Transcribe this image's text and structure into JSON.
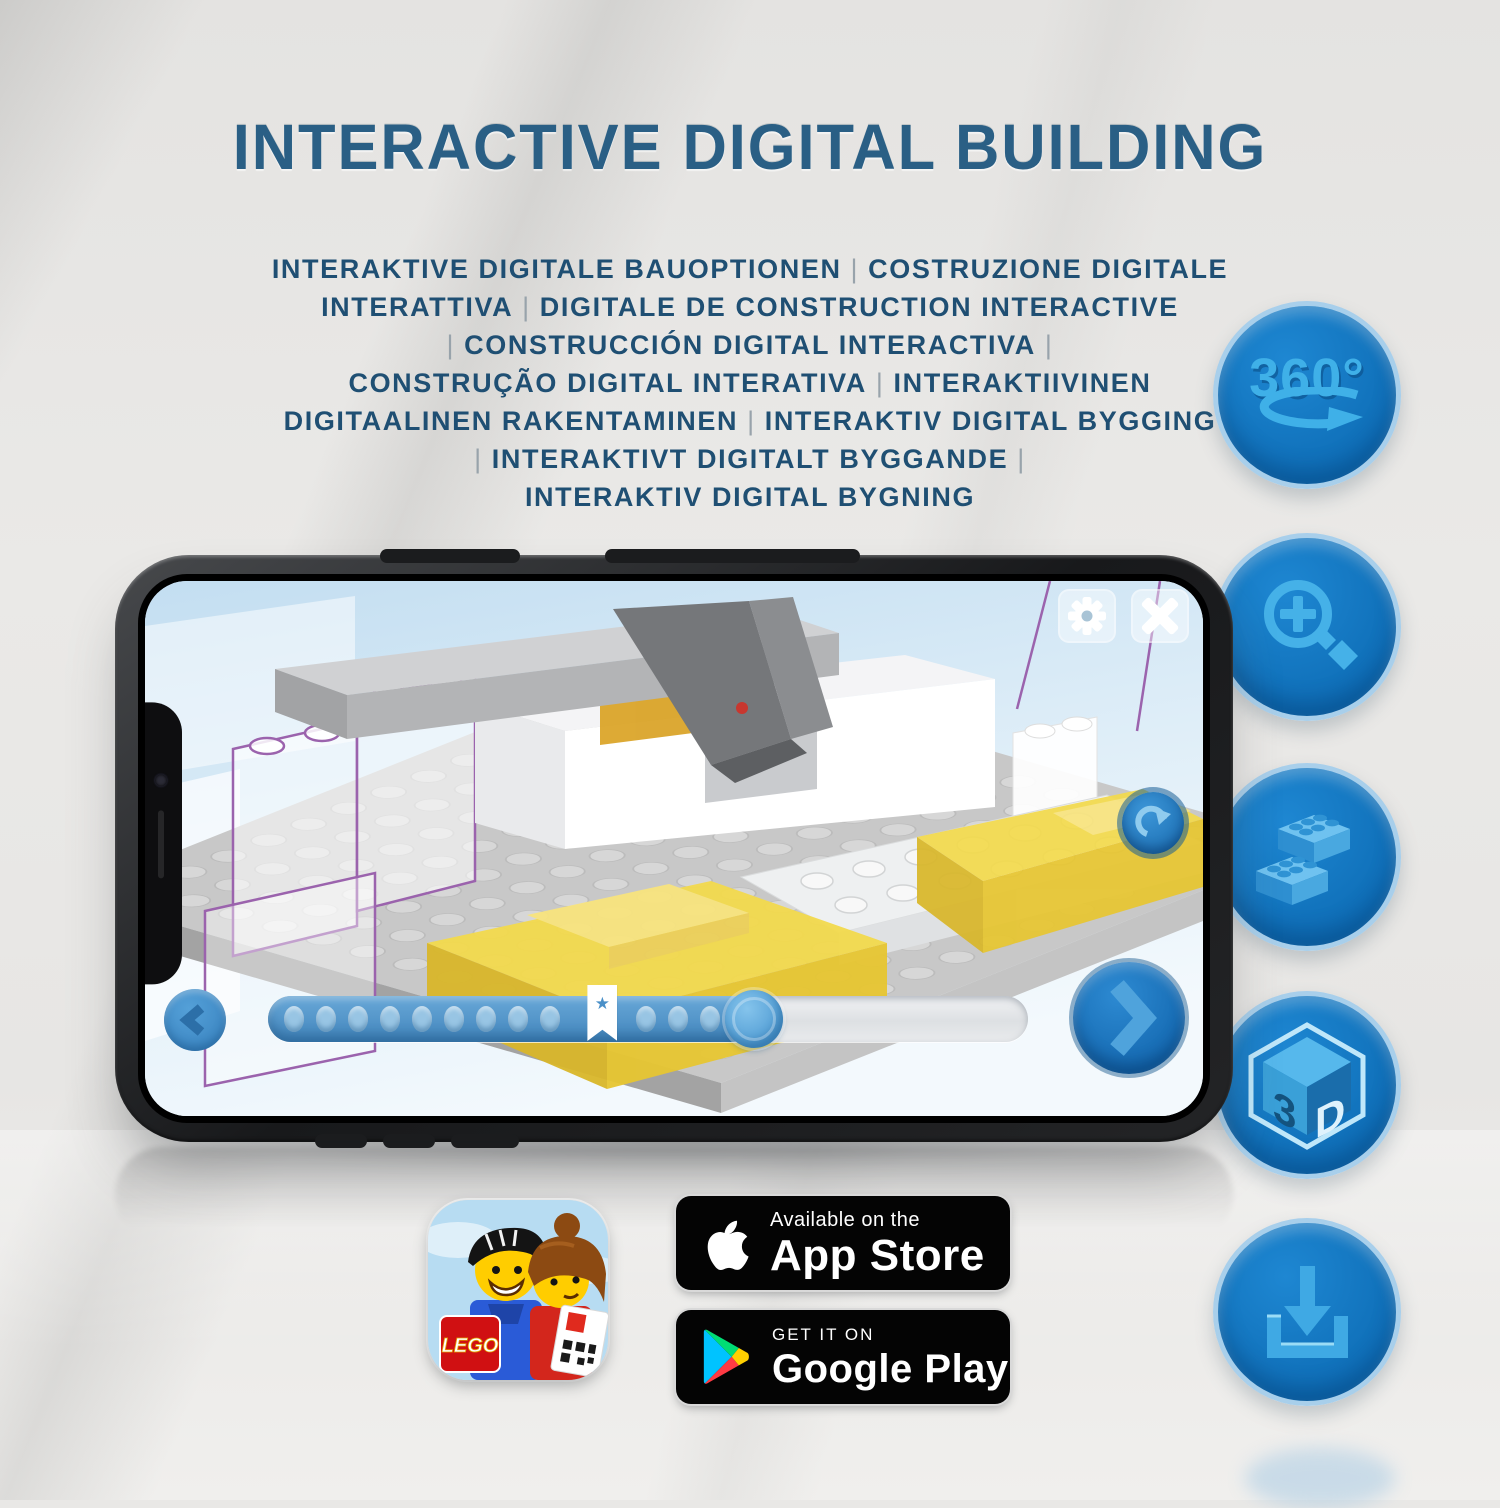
{
  "title": "INTERACTIVE DIGITAL BUILDING",
  "subtitle_lines": [
    "INTERAKTIVE DIGITALE BAUOPTIONEN | COSTRUZIONE DIGITALE",
    "INTERATTIVA | DIGITALE DE CONSTRUCTION INTERACTIVE",
    "| CONSTRUCCIÓN DIGITAL INTERACTIVA |",
    "CONSTRUÇÃO DIGITAL INTERATIVA | INTERAKTIIVINEN",
    "DIGITAALINEN RAKENTAMINEN | INTERAKTIV DIGITAL BYGGING",
    "| INTERAKTIVT DIGITALT BYGGANDE |",
    "INTERAKTIV DIGITAL BYGNING"
  ],
  "feature_icons": {
    "rotate_360": {
      "label": "360°",
      "icon": "rotate-360-icon"
    },
    "zoom": {
      "icon": "zoom-in-magnifier-icon"
    },
    "brick": {
      "icon": "lego-brick-icon"
    },
    "cube_3d": {
      "icon": "3d-cube-icon",
      "left_face_label": "3",
      "right_face_label": "D"
    },
    "download": {
      "icon": "download-icon"
    }
  },
  "phone_app": {
    "icons": {
      "settings": "gear-icon",
      "close": "close-icon",
      "rotate": "rotate-cw-icon",
      "prev": "chevron-left-icon",
      "next": "chevron-right-icon"
    },
    "progress": {
      "fill_percent": 64,
      "marker_star_percent": 44,
      "dot_count": 14,
      "marker_glyph": "★"
    }
  },
  "store": {
    "app_icon_label": "LEGO",
    "app_store": {
      "line1": "Available on the",
      "line2": "App Store"
    },
    "google_play": {
      "line1": "GET IT ON",
      "line2": "Google Play"
    }
  },
  "colors": {
    "title_blue": "#2a5f85",
    "subtitle_blue": "#1f4f73",
    "circle_fill": "#0e6fba",
    "circle_ring": "#a8cfeb",
    "glyph_blue": "#45b1e8",
    "app_accent_blue": "#4285bc",
    "brick_yellow": "#f3da4d"
  }
}
